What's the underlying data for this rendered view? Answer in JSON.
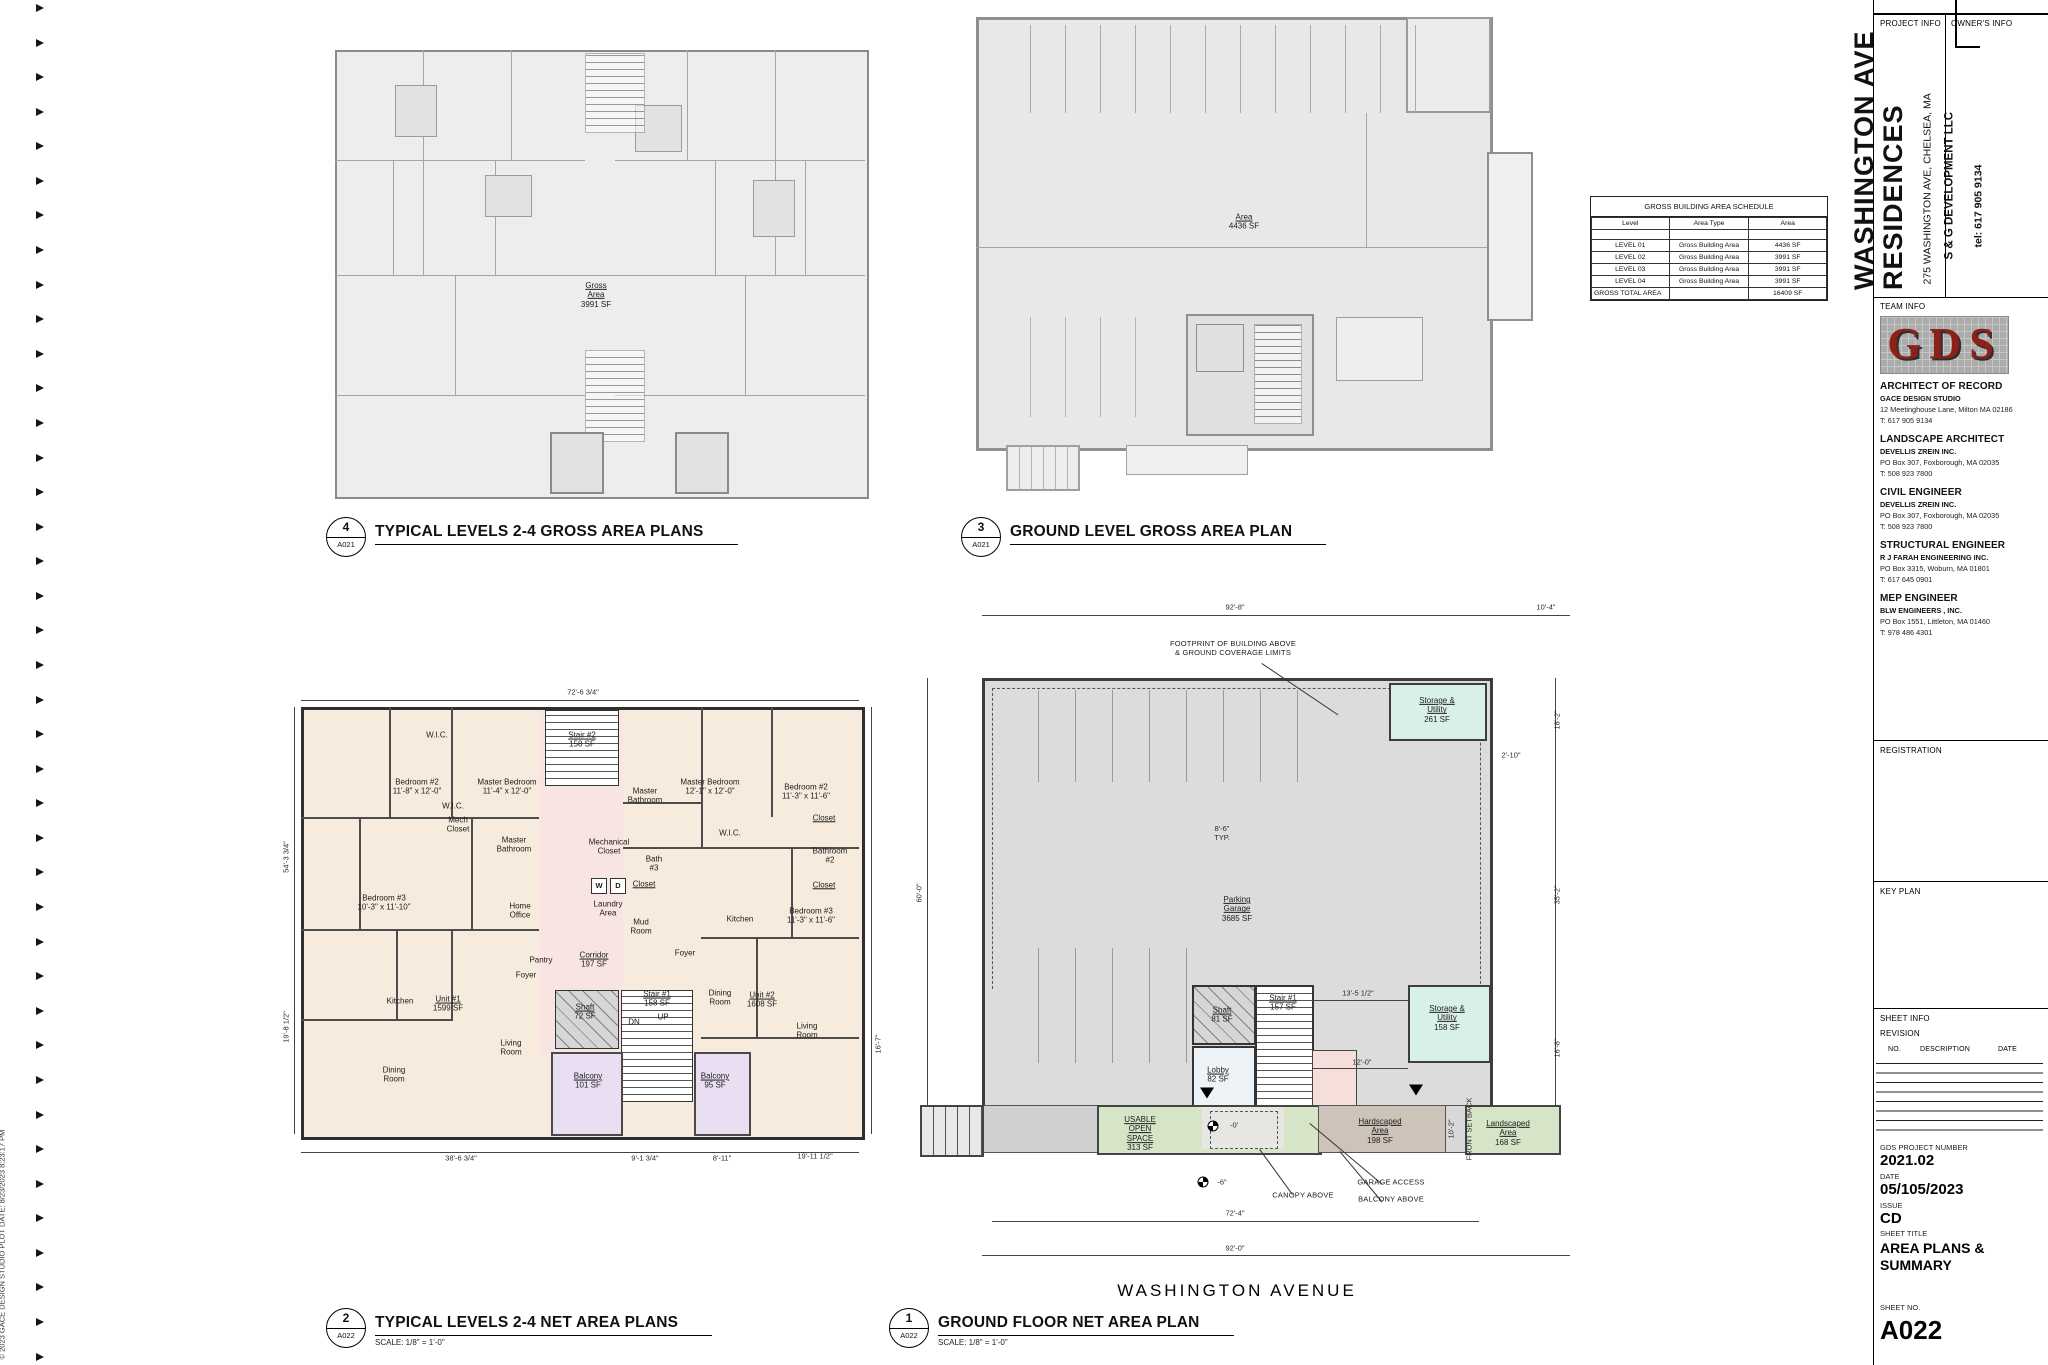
{
  "edge": {
    "copyright": "© 2023 GACE DESIGN STUDIO    PLOT DATE: 8/23/2023 8:23:17 PM"
  },
  "street_label": "WASHINGTON AVENUE",
  "schedule": {
    "title": "GROSS BUILDING AREA SCHEDULE",
    "columns": [
      "Level",
      "Area Type",
      "Area"
    ],
    "rows": [
      [
        "LEVEL 01",
        "Gross Building Area",
        "4436 SF"
      ],
      [
        "LEVEL 02",
        "Gross Building Area",
        "3991 SF"
      ],
      [
        "LEVEL 03",
        "Gross Building Area",
        "3991 SF"
      ],
      [
        "LEVEL 04",
        "Gross Building Area",
        "3991 SF"
      ]
    ],
    "total_label": "GROSS TOTAL AREA",
    "total_value": "16409 SF"
  },
  "viewports": [
    {
      "num": "4",
      "ref": "A021",
      "title": "TYPICAL LEVELS 2-4 GROSS AREA PLANS",
      "scale": ""
    },
    {
      "num": "3",
      "ref": "A021",
      "title": "GROUND LEVEL GROSS AREA PLAN",
      "scale": ""
    },
    {
      "num": "2",
      "ref": "A022",
      "title": "TYPICAL LEVELS 2-4 NET AREA PLANS",
      "scale": "SCALE:   1/8\" = 1'-0\""
    },
    {
      "num": "1",
      "ref": "A022",
      "title": "GROUND FLOOR NET AREA PLAN",
      "scale": "SCALE:   1/8\" = 1'-0\""
    }
  ],
  "plan4": {
    "labels": [
      {
        "x": 261,
        "y": 245,
        "lines": [
          "Gross",
          "Area",
          "3991 SF"
        ],
        "u": 1
      }
    ]
  },
  "plan3": {
    "labels": [
      {
        "x": 268,
        "y": 205,
        "lines": [
          "Area",
          "4436 SF"
        ],
        "u": 1
      }
    ]
  },
  "plan2": {
    "labels": [
      {
        "x": 136,
        "y": 28,
        "lines": [
          "W.I.C."
        ]
      },
      {
        "x": 281,
        "y": 33,
        "lines": [
          "Stair #2",
          "158 SF"
        ],
        "u": 1
      },
      {
        "x": 116,
        "y": 80,
        "lines": [
          "Bedroom #2",
          "11'-8\" x 12'-0\""
        ]
      },
      {
        "x": 206,
        "y": 80,
        "lines": [
          "Master Bedroom",
          "11'-4\" x 12'-0\""
        ]
      },
      {
        "x": 152,
        "y": 99,
        "lines": [
          "W.I.C."
        ]
      },
      {
        "x": 157,
        "y": 118,
        "lines": [
          "Mech",
          "Closet"
        ]
      },
      {
        "x": 213,
        "y": 138,
        "lines": [
          "Master",
          "Bathroom"
        ]
      },
      {
        "x": 83,
        "y": 196,
        "lines": [
          "Bedroom #3",
          "10'-3\" x 11'-10\""
        ]
      },
      {
        "x": 219,
        "y": 204,
        "lines": [
          "Home",
          "Office"
        ]
      },
      {
        "x": 240,
        "y": 253,
        "lines": [
          "Pantry"
        ]
      },
      {
        "x": 99,
        "y": 294,
        "lines": [
          "Kitchen"
        ]
      },
      {
        "x": 147,
        "y": 297,
        "lines": [
          "Unit #1",
          "1599 SF"
        ],
        "u": 1
      },
      {
        "x": 225,
        "y": 268,
        "lines": [
          "Foyer"
        ]
      },
      {
        "x": 93,
        "y": 368,
        "lines": [
          "Dining",
          "Room"
        ]
      },
      {
        "x": 210,
        "y": 341,
        "lines": [
          "Living",
          "Room"
        ]
      },
      {
        "x": 287,
        "y": 374,
        "lines": [
          "Balcony",
          "101 SF"
        ],
        "u": 1
      },
      {
        "x": 308,
        "y": 140,
        "lines": [
          "Mechanical",
          "Closet"
        ]
      },
      {
        "x": 344,
        "y": 89,
        "lines": [
          "Master",
          "Bathroom"
        ]
      },
      {
        "x": 353,
        "y": 157,
        "lines": [
          "Bath",
          "#3"
        ]
      },
      {
        "x": 343,
        "y": 177,
        "lines": [
          "Closet"
        ],
        "u": 1
      },
      {
        "x": 298,
        "y": 179,
        "lines": [
          "W"
        ],
        "cls": "wd"
      },
      {
        "x": 317,
        "y": 179,
        "lines": [
          "D"
        ],
        "cls": "wd"
      },
      {
        "x": 307,
        "y": 202,
        "lines": [
          "Laundry",
          "Area"
        ]
      },
      {
        "x": 340,
        "y": 220,
        "lines": [
          "Mud",
          "Room"
        ]
      },
      {
        "x": 293,
        "y": 253,
        "lines": [
          "Corridor",
          "197 SF"
        ],
        "u": 1
      },
      {
        "x": 384,
        "y": 246,
        "lines": [
          "Foyer"
        ]
      },
      {
        "x": 284,
        "y": 305,
        "lines": [
          "Shaft",
          "72 SF"
        ],
        "u": 1
      },
      {
        "x": 356,
        "y": 292,
        "lines": [
          "Stair #1",
          "158 SF"
        ],
        "u": 1
      },
      {
        "x": 362,
        "y": 310,
        "lines": [
          "UP"
        ]
      },
      {
        "x": 333,
        "y": 315,
        "lines": [
          "DN"
        ]
      },
      {
        "x": 414,
        "y": 374,
        "lines": [
          "Balcony",
          "95 SF"
        ],
        "u": 1
      },
      {
        "x": 409,
        "y": 80,
        "lines": [
          "Master Bedroom",
          "12'-1\" x 12'-0\""
        ]
      },
      {
        "x": 429,
        "y": 126,
        "lines": [
          "W.I.C."
        ]
      },
      {
        "x": 505,
        "y": 85,
        "lines": [
          "Bedroom #2",
          "11'-3\" x 11'-6\""
        ]
      },
      {
        "x": 523,
        "y": 111,
        "lines": [
          "Closet"
        ],
        "u": 1
      },
      {
        "x": 529,
        "y": 149,
        "lines": [
          "Bathroom",
          "#2"
        ]
      },
      {
        "x": 523,
        "y": 178,
        "lines": [
          "Closet"
        ],
        "u": 1
      },
      {
        "x": 510,
        "y": 209,
        "lines": [
          "Bedroom #3",
          "11'-3\" x 11'-6\""
        ]
      },
      {
        "x": 439,
        "y": 212,
        "lines": [
          "Kitchen"
        ]
      },
      {
        "x": 419,
        "y": 291,
        "lines": [
          "Dining",
          "Room"
        ]
      },
      {
        "x": 461,
        "y": 293,
        "lines": [
          "Unit #2",
          "1608 SF"
        ],
        "u": 1
      },
      {
        "x": 506,
        "y": 324,
        "lines": [
          "Living",
          "Room"
        ]
      }
    ],
    "dims": [
      {
        "x": 282,
        "y": -14,
        "lines": [
          "72'-6 3/4\""
        ],
        "cls": "dim"
      },
      {
        "x": -14,
        "y": 150,
        "lines": [
          "54'-3 3/4\""
        ],
        "cls": "dim",
        "rot": 1
      },
      {
        "x": -14,
        "y": 320,
        "lines": [
          "19'-8 1/2\""
        ],
        "cls": "dim",
        "rot": 1
      },
      {
        "x": 160,
        "y": 452,
        "lines": [
          "38'-6 3/4\""
        ],
        "cls": "dim"
      },
      {
        "x": 344,
        "y": 452,
        "lines": [
          "9'-1 3/4\""
        ],
        "cls": "dim"
      },
      {
        "x": 421,
        "y": 452,
        "lines": [
          "8'-11\""
        ],
        "cls": "dim"
      },
      {
        "x": 514,
        "y": 450,
        "lines": [
          "19'-11 1/2\""
        ],
        "cls": "dim"
      },
      {
        "x": 578,
        "y": 337,
        "lines": [
          "16'-7\""
        ],
        "cls": "dim",
        "rot": 1
      }
    ]
  },
  "plan1": {
    "labels": [
      {
        "x": 327,
        "y": 346,
        "lines": [
          "Parking",
          "Garage",
          "3685 SF"
        ],
        "u": 1
      },
      {
        "x": 527,
        "y": 147,
        "lines": [
          "Storage &",
          "Utility",
          "261 SF"
        ],
        "u": 1
      },
      {
        "x": 537,
        "y": 455,
        "lines": [
          "Storage &",
          "Utility",
          "158 SF"
        ],
        "u": 1
      },
      {
        "x": 373,
        "y": 440,
        "lines": [
          "Stair #1",
          "157 SF"
        ],
        "u": 1
      },
      {
        "x": 312,
        "y": 452,
        "lines": [
          "Shaft",
          "81 SF"
        ],
        "u": 1
      },
      {
        "x": 308,
        "y": 512,
        "lines": [
          "Lobby",
          "82 SF"
        ],
        "u": 1
      },
      {
        "x": 230,
        "y": 571,
        "lines": [
          "USABLE",
          "OPEN",
          "SPACE",
          "313 SF"
        ],
        "u": 1
      },
      {
        "x": 470,
        "y": 568,
        "lines": [
          "Hardscaped",
          "Area",
          "198 SF"
        ],
        "u": 1
      },
      {
        "x": 598,
        "y": 570,
        "lines": [
          "Landscaped",
          "Area",
          "168 SF"
        ],
        "u": 1
      },
      {
        "x": 560,
        "y": 566,
        "lines": [
          "FRONT SETBACK"
        ],
        "rot": 1,
        "cls": "dim"
      }
    ],
    "dims": [
      {
        "x": 325,
        "y": 45,
        "lines": [
          "92'-8\""
        ],
        "cls": "dim"
      },
      {
        "x": 636,
        "y": 45,
        "lines": [
          "10'-4\""
        ],
        "cls": "dim"
      },
      {
        "x": 10,
        "y": 330,
        "lines": [
          "60'-0\""
        ],
        "cls": "dim",
        "rot": 1
      },
      {
        "x": 312,
        "y": 271,
        "lines": [
          "8'-6\"",
          "TYP."
        ],
        "cls": "dim"
      },
      {
        "x": 601,
        "y": 193,
        "lines": [
          "2'-10\""
        ],
        "cls": "dim"
      },
      {
        "x": 648,
        "y": 157,
        "lines": [
          "18'-2\""
        ],
        "cls": "dim",
        "rot": 1
      },
      {
        "x": 648,
        "y": 332,
        "lines": [
          "35'-2\""
        ],
        "cls": "dim",
        "rot": 1
      },
      {
        "x": 648,
        "y": 485,
        "lines": [
          "16'-8\""
        ],
        "cls": "dim",
        "rot": 1
      },
      {
        "x": 448,
        "y": 431,
        "lines": [
          "13'-5 1/2\""
        ],
        "cls": "dim"
      },
      {
        "x": 452,
        "y": 500,
        "lines": [
          "12'-0\""
        ],
        "cls": "dim"
      },
      {
        "x": 542,
        "y": 566,
        "lines": [
          "10'-2\""
        ],
        "cls": "dim",
        "rot": 1
      },
      {
        "x": 325,
        "y": 651,
        "lines": [
          "72'-4\""
        ],
        "cls": "dim"
      },
      {
        "x": 325,
        "y": 686,
        "lines": [
          "92'-0\""
        ],
        "cls": "dim"
      },
      {
        "x": 324,
        "y": 563,
        "lines": [
          "-0'"
        ],
        "cls": "dim"
      },
      {
        "x": 312,
        "y": 620,
        "lines": [
          "-6\""
        ],
        "cls": "dim"
      }
    ],
    "callouts": [
      {
        "x": 323,
        "y": 86,
        "lines": [
          "FOOTPRINT OF BUILDING ABOVE",
          "& GROUND COVERAGE LIMITS"
        ],
        "cls": "callout"
      },
      {
        "x": 393,
        "y": 633,
        "lines": [
          "CANOPY ABOVE"
        ],
        "cls": "callout"
      },
      {
        "x": 481,
        "y": 620,
        "lines": [
          "GARAGE ACCESS"
        ],
        "cls": "callout"
      },
      {
        "x": 481,
        "y": 637,
        "lines": [
          "BALCONY ABOVE"
        ],
        "cls": "callout"
      }
    ]
  },
  "title_block": {
    "project_info_label": "PROJECT INFO",
    "owner_info_label": "OWNER'S INFO",
    "project_name1": "WASHINGTON AVE",
    "project_name2": "RESIDENCES",
    "project_address": "275 WASHINGTON AVE, CHELSEA, MA",
    "owner_name": "S & G DEVELOPMENT LLC",
    "owner_tel": "tel: 617 905 9134",
    "team_info_label": "TEAM INFO",
    "logo_text": "GDS",
    "team": [
      {
        "role": "ARCHITECT OF RECORD",
        "firm": "GACE DESIGN STUDIO",
        "address": "12 Meetinghouse Lane, Milton MA 02186",
        "tel": "T: 617 905 9134"
      },
      {
        "role": "LANDSCAPE ARCHITECT",
        "firm": "DEVELLIS ZREIN INC.",
        "address": "PO Box 307, Foxborough, MA 02035",
        "tel": "T: 508 923 7800"
      },
      {
        "role": "CIVIL ENGINEER",
        "firm": "DEVELLIS ZREIN INC.",
        "address": "PO Box 307, Foxborough, MA 02035",
        "tel": "T: 508 923 7800"
      },
      {
        "role": "STRUCTURAL ENGINEER",
        "firm": "R J FARAH ENGINEERING INC.",
        "address": "PO Box 3315, Woburn, MA 01801",
        "tel": "T: 617 645 0901"
      },
      {
        "role": "MEP ENGINEER",
        "firm": "BLW ENGINEERS , INC.",
        "address": "PO Box 1551, Littleton, MA 01460",
        "tel": "T: 978 486 4301"
      }
    ],
    "registration_label": "REGISTRATION",
    "key_plan_label": "KEY PLAN",
    "sheet_info_label": "SHEET INFO",
    "revision_label": "REVISION",
    "revision_columns": [
      "NO.",
      "DESCRIPTION",
      "DATE"
    ],
    "project_number_label": "GDS PROJECT NUMBER",
    "project_number": "2021.02",
    "date_label": "DATE",
    "date": "05/105/2023",
    "issue_label": "ISSUE",
    "issue": "CD",
    "sheet_title_label": "SHEET TITLE",
    "sheet_title_line1": "AREA PLANS &",
    "sheet_title_line2": "SUMMARY",
    "sheet_no_label": "SHEET NO.",
    "sheet_no": "A022"
  }
}
